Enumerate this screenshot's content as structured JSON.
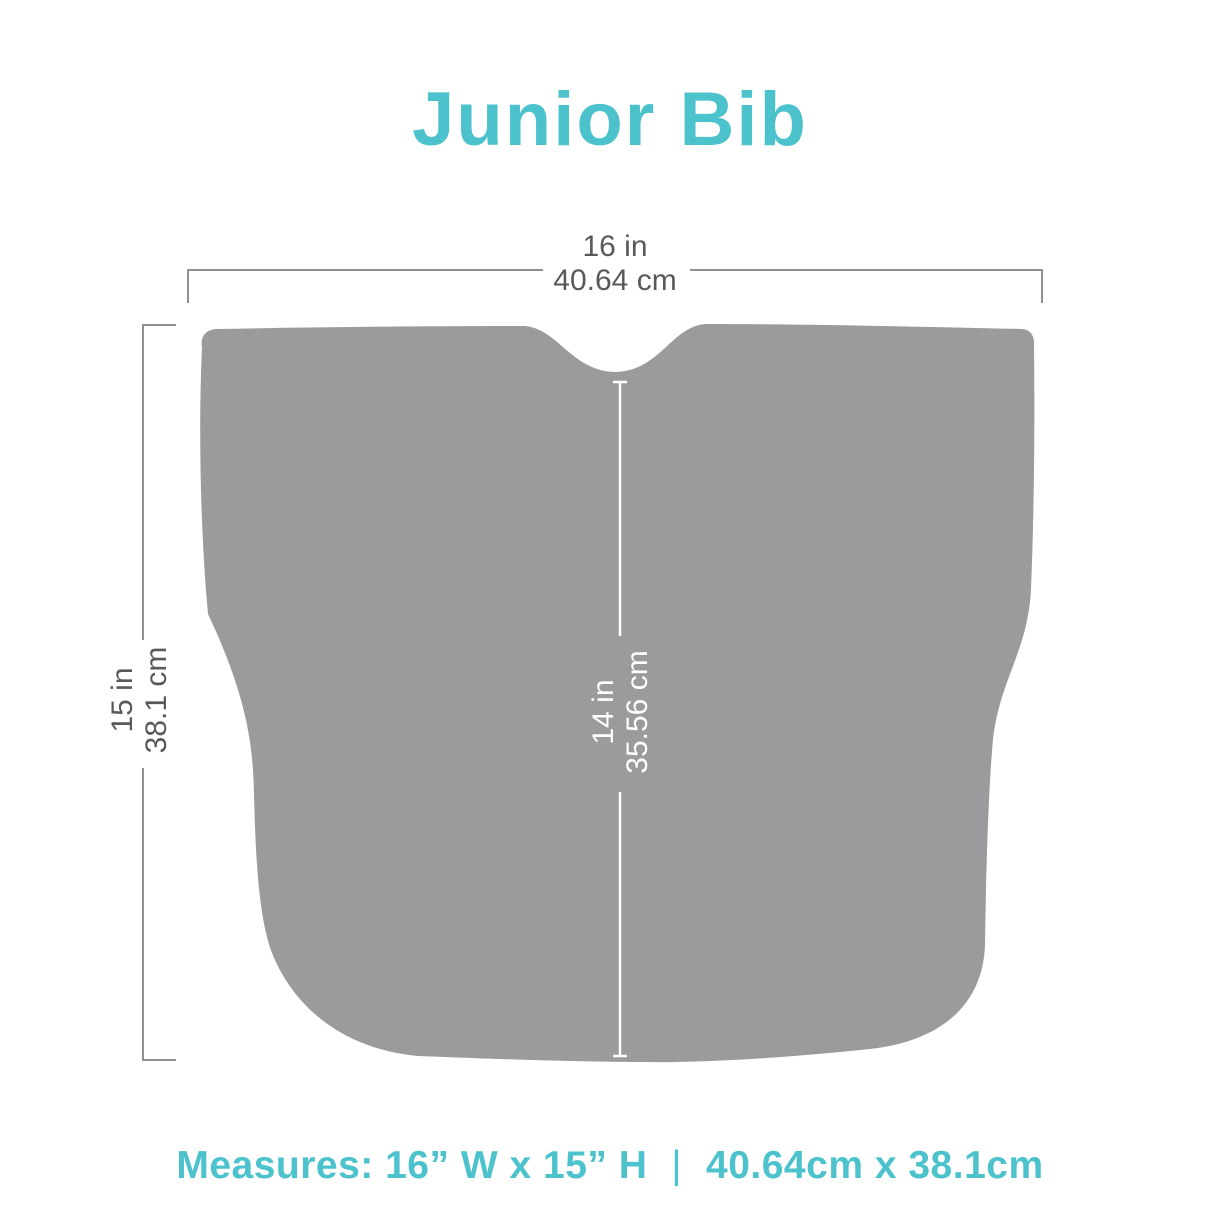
{
  "title": "Junior Bib",
  "dimensions": {
    "width": {
      "in": "16 in",
      "cm": "40.64 cm"
    },
    "height": {
      "in": "15 in",
      "cm": "38.1 cm"
    },
    "inner_height": {
      "in": "14 in",
      "cm": "35.56 cm"
    }
  },
  "footer": {
    "imperial": "Measures: 16” W x 15” H",
    "separator": "|",
    "metric": "40.64cm x 38.1cm"
  },
  "colors": {
    "accent": "#4BC2CC",
    "bib_fill": "#9B9B9D",
    "dim_line": "#8F9093",
    "dim_text": "#58595B",
    "inner_line": "#FFFFFF"
  }
}
